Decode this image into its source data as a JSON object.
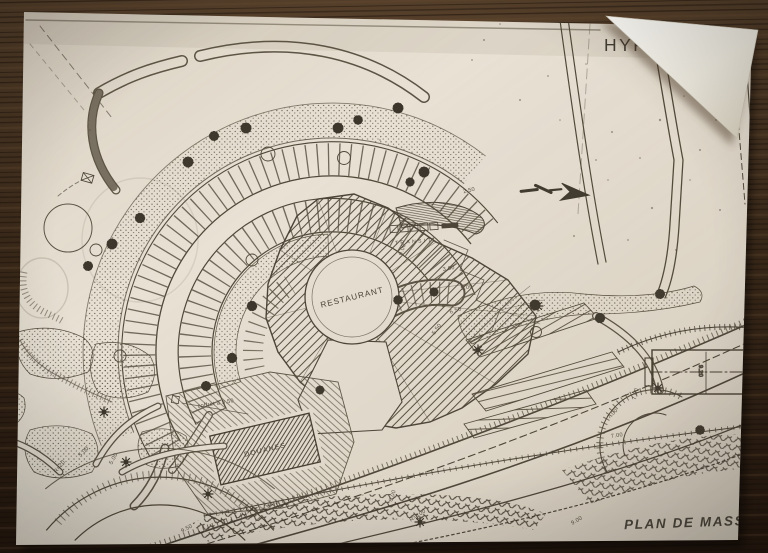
{
  "titles": {
    "hypothese": "HYPOTHESE",
    "hypothese_number": "1",
    "caption": "PLAN DE MASSE"
  },
  "labels": {
    "restaurant": "RESTAURANT",
    "douanes": "DOUANES",
    "transit": "TRANSIT",
    "coffret": "coffret à 3.50"
  },
  "dims": [
    "9.00",
    "3.00",
    "5.00",
    "6.50",
    "5.50",
    "7.00",
    "7.00",
    "7.00",
    "R=20",
    "5.00",
    "5.00",
    "9.50",
    "R=100",
    "6.00",
    "9.20",
    "2.50",
    "9.00"
  ],
  "symbols": {
    "north_arrow": "north-arrow"
  },
  "colors": {
    "paper": "#e8e1d4",
    "ink": "#4a4337",
    "wood": "#32231a"
  }
}
